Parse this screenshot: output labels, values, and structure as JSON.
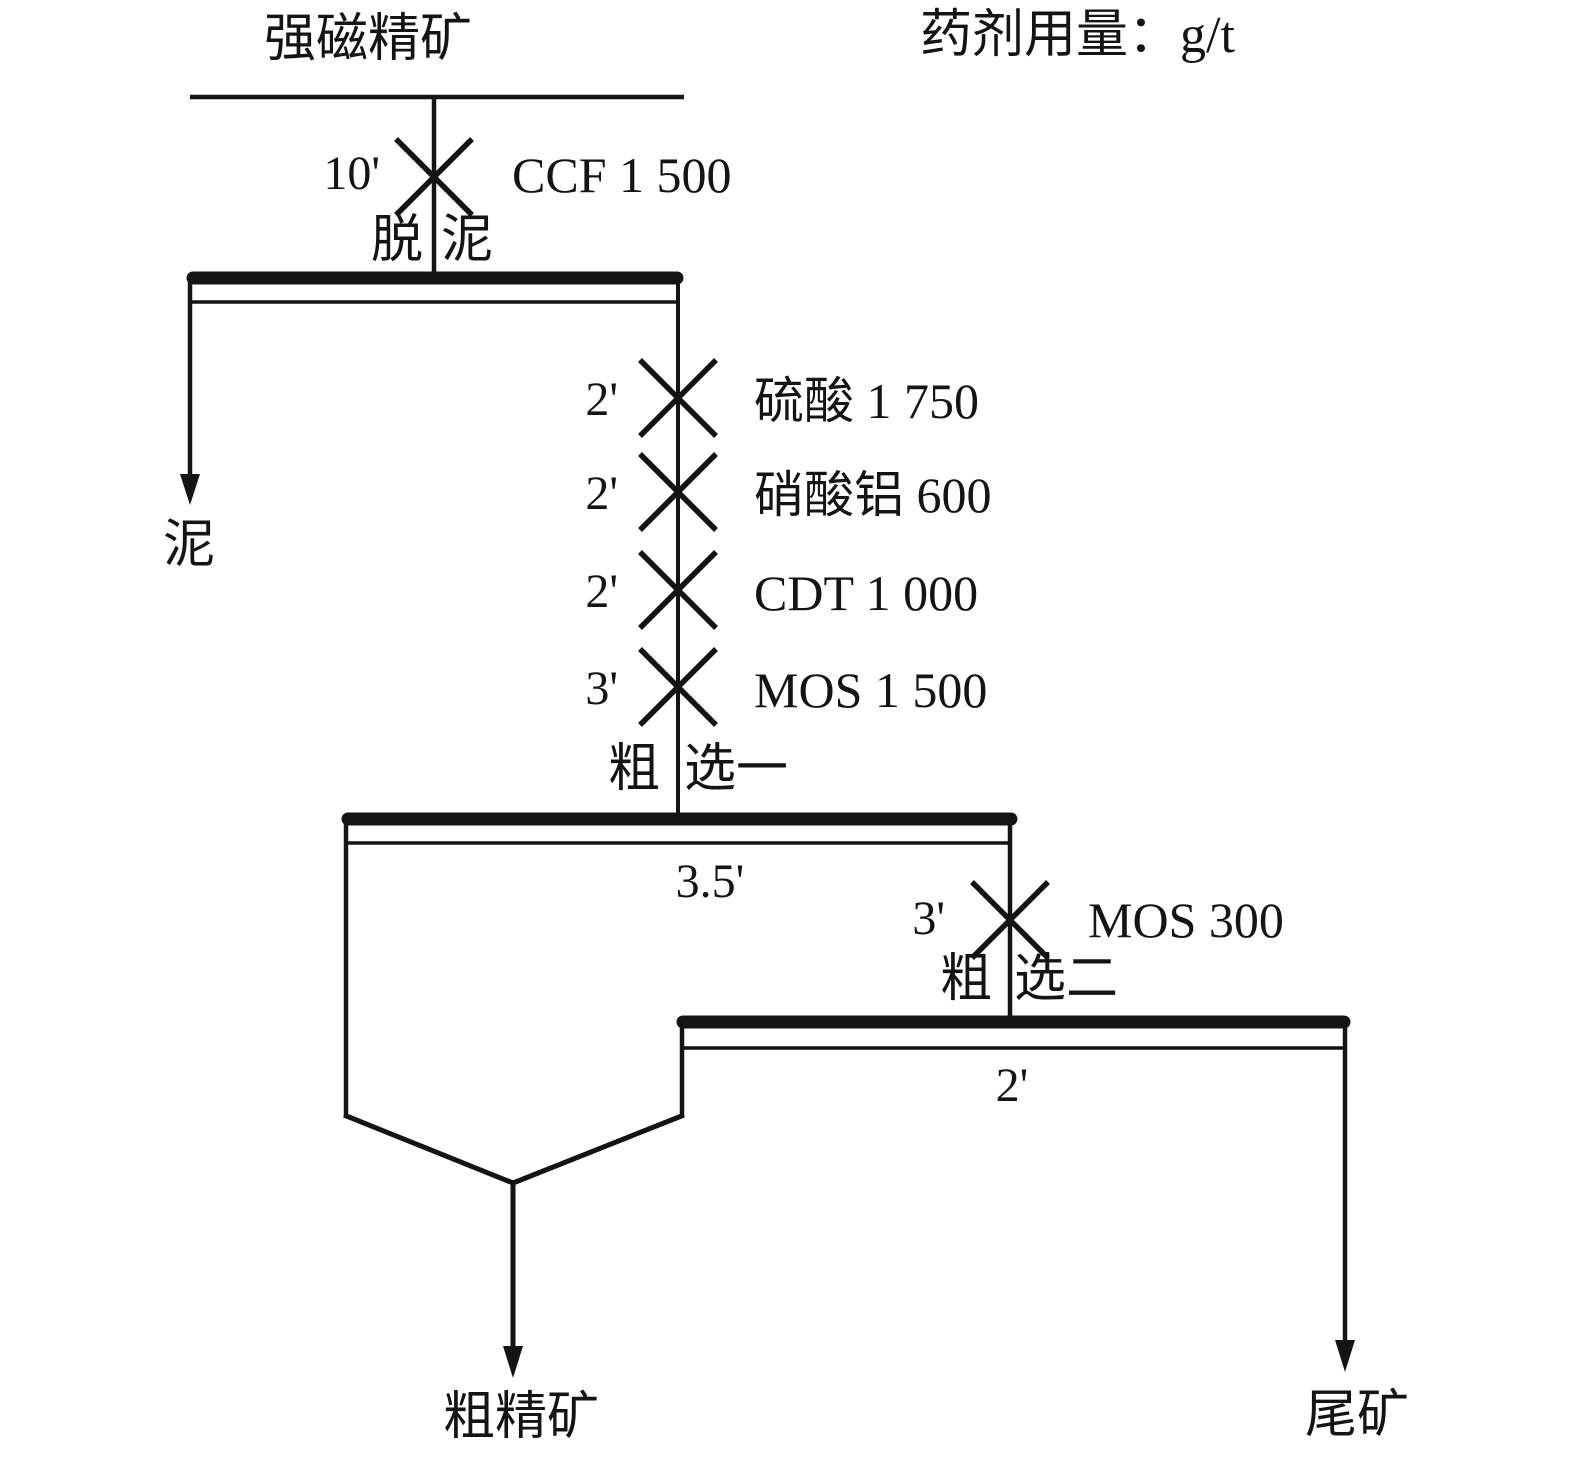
{
  "header": {
    "feed_label": "强磁精矿",
    "dosage_note": "药剂用量：g/t"
  },
  "desliming": {
    "cond_time": "10'",
    "reagent": "CCF 1 500",
    "stage_left": "脱",
    "stage_right": "泥",
    "slime_product": "泥"
  },
  "conditioning": [
    {
      "time": "2'",
      "reagent": "硫酸 1 750"
    },
    {
      "time": "2'",
      "reagent": "硝酸铝 600"
    },
    {
      "time": "2'",
      "reagent": "CDT 1 000"
    },
    {
      "time": "3'",
      "reagent": "MOS 1 500"
    }
  ],
  "rougher1": {
    "stage_left": "粗",
    "stage_right": "选一",
    "flotation_time": "3.5'"
  },
  "rougher2": {
    "cond_time": "3'",
    "reagent": "MOS 300",
    "stage_left": "粗",
    "stage_right": "选二",
    "flotation_time": "2'"
  },
  "products": {
    "concentrate": "粗精矿",
    "tailings": "尾矿"
  }
}
